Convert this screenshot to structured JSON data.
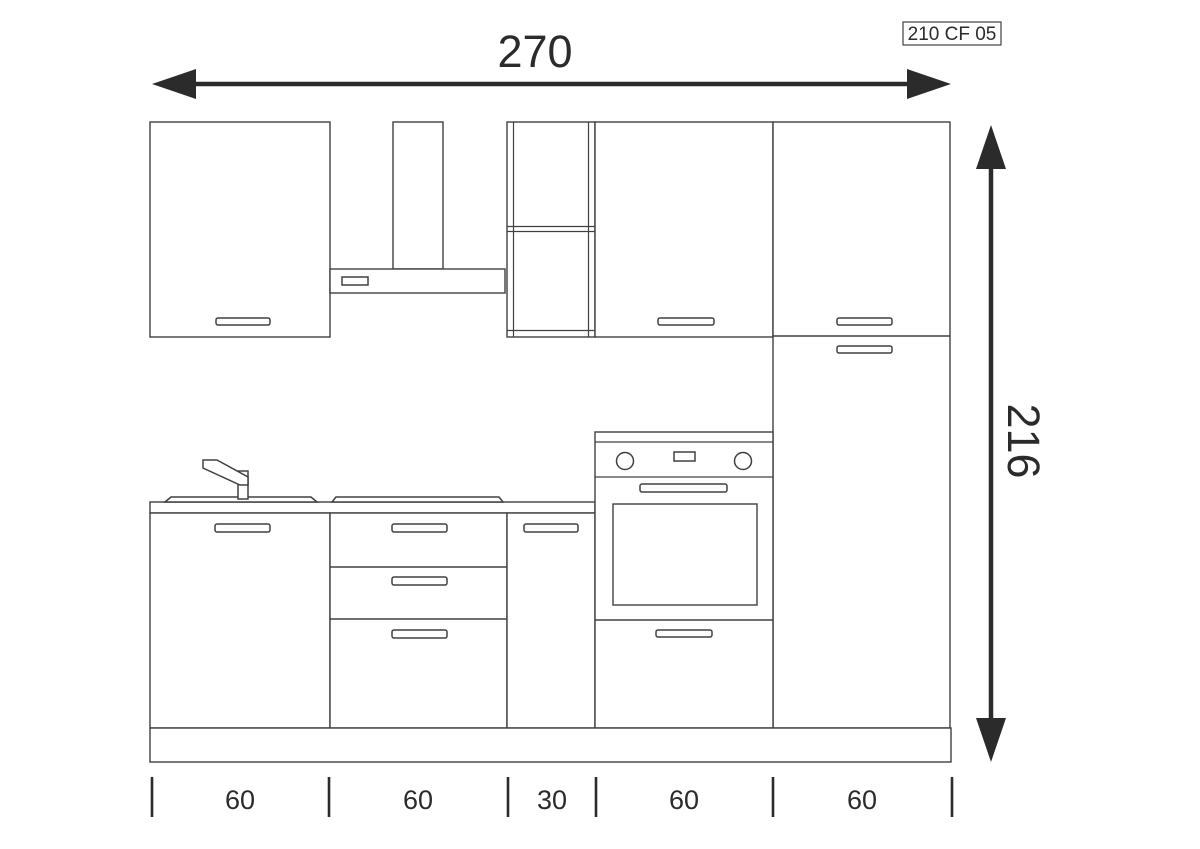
{
  "title_block": {
    "model_code": "210 CF 05"
  },
  "dimensions": {
    "overall_width_cm": "270",
    "overall_height_cm": "216",
    "segment_widths_cm": [
      "60",
      "60",
      "30",
      "60",
      "60"
    ]
  },
  "components": [
    "wall-cabinet-left",
    "cooker-hood",
    "open-shelf-unit",
    "wall-cabinet-right",
    "tall-cabinet",
    "countertop",
    "sink",
    "faucet",
    "cooktop",
    "sink-base-cabinet",
    "drawer-base-cabinet",
    "base-cabinet-30",
    "built-in-oven-unit",
    "plinth"
  ],
  "colors": {
    "background": "#ffffff",
    "drawing_line": "#404040",
    "annotation": "#2b2b2b"
  }
}
